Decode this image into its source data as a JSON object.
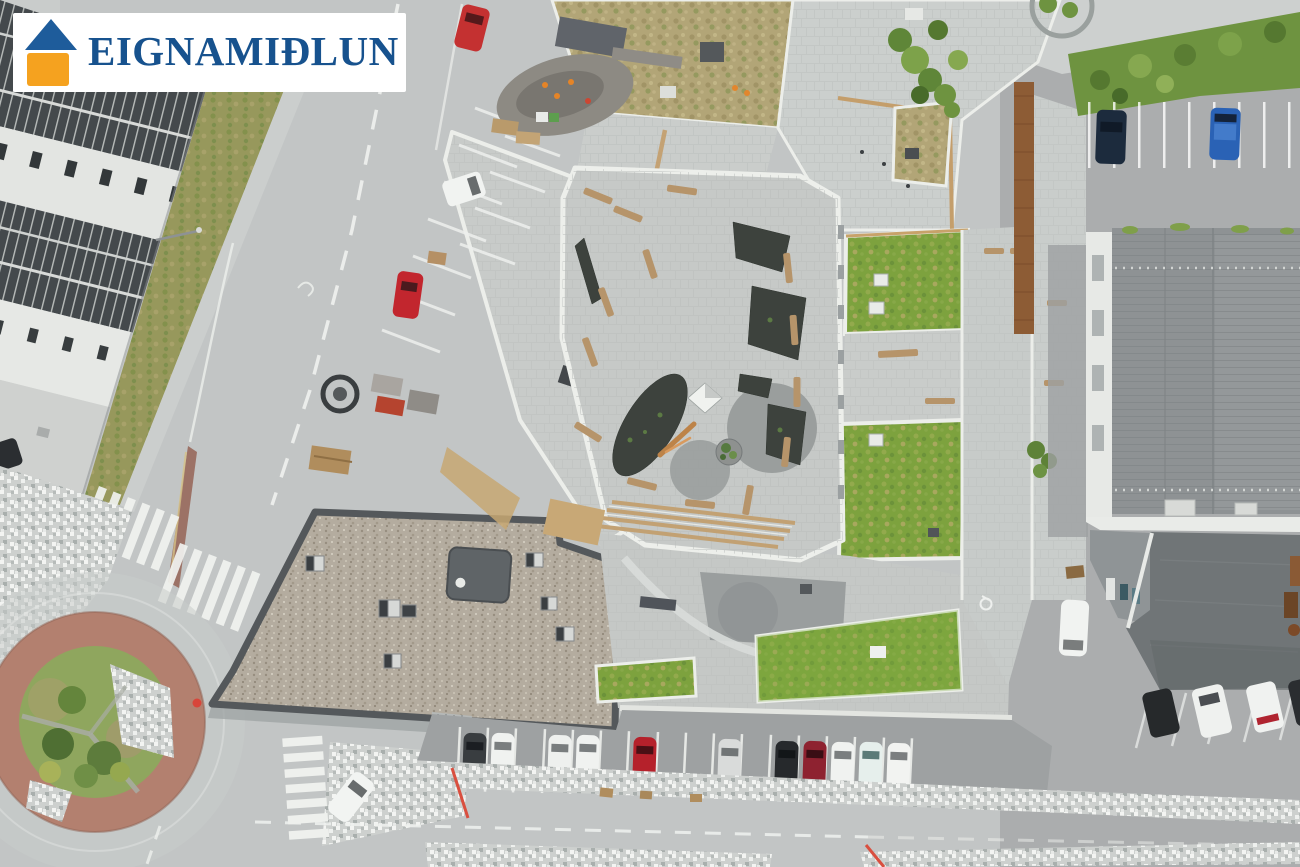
{
  "watermark": {
    "brand_name": "EIGNAMIÐLUN",
    "icon": "house-logo-icon",
    "colors": {
      "roof_blue": "#1E5C9B",
      "body_orange": "#F5A21F",
      "text_navy": "#17528E",
      "plate_white": "#FFFFFF"
    }
  },
  "scene": {
    "kind": "aerial-drone-photograph",
    "palette": {
      "asphalt": "#C2C5C5",
      "dark_asphalt": "#A7AAAB",
      "paver_light": "#CBCFCD",
      "gravel_roof": "#B4AC9F",
      "metal_roof": "#8E9294",
      "metal_roof_dark": "#707577",
      "green_roof": "#7DA23E",
      "dried_grass_roof": "#B2A577",
      "grass": "#8FA65E",
      "roundabout_brick": "#B3806F",
      "wood": "#C49E6B",
      "white_wall": "#ECEEEA",
      "planting_bed": "#3D423D",
      "hedge": "#6E9340",
      "corten_rust": "#8D5C35"
    },
    "vehicle_colors": {
      "red": "#C2262E",
      "white": "#F0F2F0",
      "silver": "#D9DBDA",
      "black": "#26292C",
      "navy": "#1C2B3D",
      "blue": "#2A62B5",
      "dark_red": "#8E2230"
    }
  }
}
